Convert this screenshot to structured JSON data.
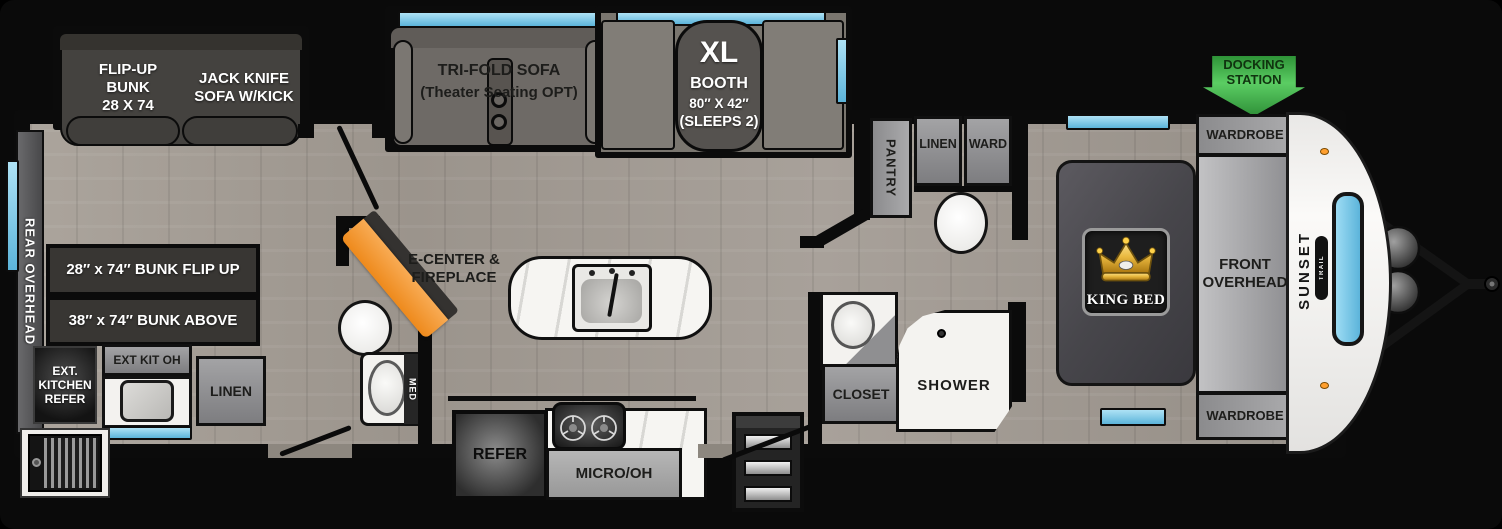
{
  "colors": {
    "background": "#0a0a0a",
    "floor_wood": "#a6a099",
    "window_blue": "#7cc6e6",
    "docking_green": "#46b14c",
    "fireplace_orange": "#f0922e",
    "crown_gold": "#d4a017",
    "nose_white": "#f2f1ef"
  },
  "docking_station": {
    "lines": [
      "DOCKING",
      "STATION"
    ]
  },
  "rear": {
    "overhead": "REAR OVERHEAD"
  },
  "bunk_room": {
    "flip_up_bunk": [
      "FLIP-UP",
      "BUNK",
      "28 X 74"
    ],
    "jack_knife_sofa": [
      "JACK KNIFE",
      "SOFA W/KICK"
    ],
    "bunk_top": "28″ x 74″ BUNK FLIP UP",
    "bunk_bottom": "38″ x 74″ BUNK ABOVE"
  },
  "exterior_kitchen": {
    "refer": [
      "EXT.",
      "KITCHEN",
      "REFER"
    ],
    "overhead": "EXT KIT OH",
    "linen": "LINEN"
  },
  "living": {
    "tri_fold_sofa": [
      "TRI-FOLD SOFA",
      "(Theater Seating OPT)"
    ],
    "booth": {
      "size": "XL",
      "name": "BOOTH",
      "dims": "80″ X 42″",
      "sleeps": "(SLEEPS 2)"
    },
    "ecenter": [
      "E-CENTER &",
      "FIREPLACE"
    ]
  },
  "mid_bath": {
    "med": "MED"
  },
  "kitchen": {
    "refer": "REFER",
    "micro_oh": "MICRO/OH"
  },
  "rear_bath": {
    "pantry": "PANTRY",
    "linen": "LINEN",
    "ward": "WARD",
    "closet": "CLOSET",
    "shower": "SHOWER"
  },
  "bedroom": {
    "bed": "KING BED",
    "front_overhead": [
      "FRONT",
      "OVERHEAD"
    ],
    "wardrobe_top": "WARDROBE",
    "wardrobe_bottom": "WARDROBE"
  },
  "brand": {
    "name": "SUNSET",
    "series": "TRAIL"
  }
}
